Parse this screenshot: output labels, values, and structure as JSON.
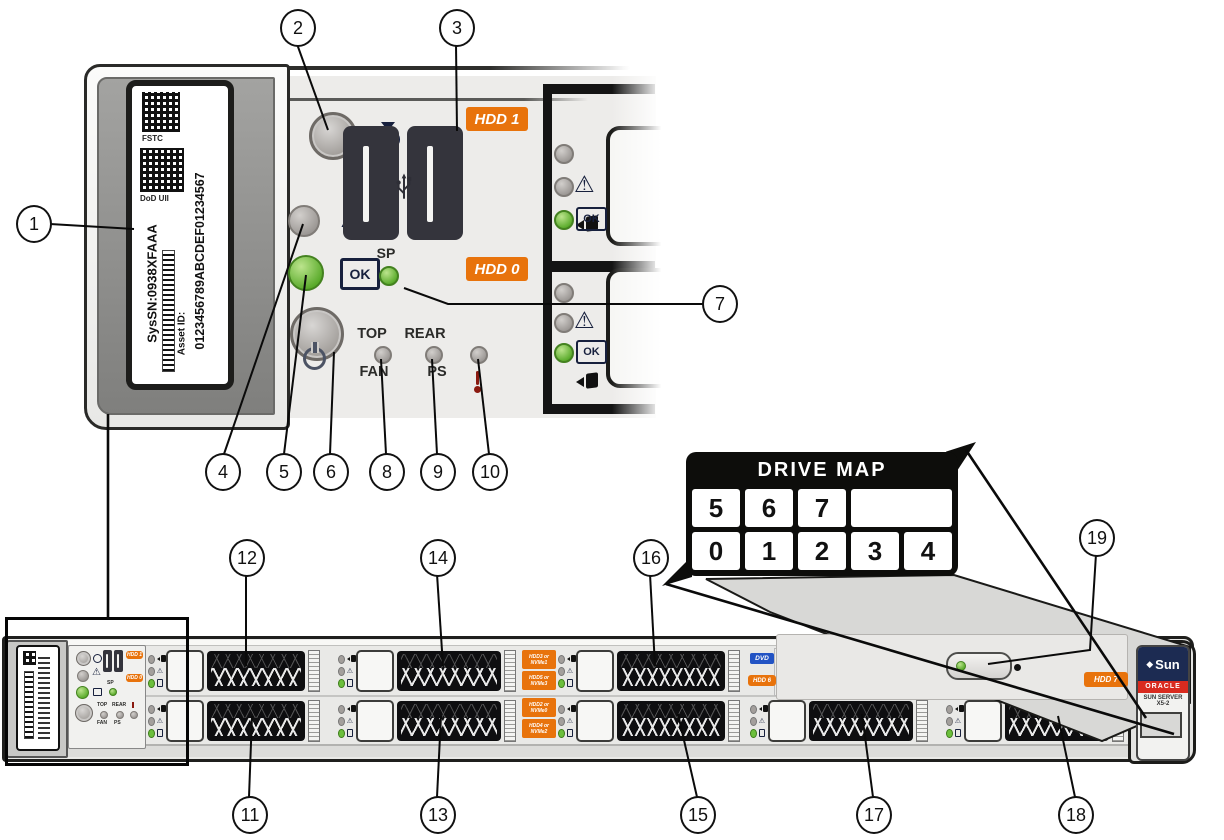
{
  "callouts": [
    "1",
    "2",
    "3",
    "4",
    "5",
    "6",
    "7",
    "8",
    "9",
    "10",
    "11",
    "12",
    "13",
    "14",
    "15",
    "16",
    "17",
    "18",
    "19"
  ],
  "service_label": {
    "qr1_caption": "FSTC",
    "qr2_caption": "DoD UII",
    "system_serial": "SysSN:0938XFAAA",
    "asset_id_label": "Asset ID:",
    "asset_id_value": "0123456789ABCDEF01234567"
  },
  "control_panel": {
    "sp": "SP",
    "ok": "OK",
    "top": "TOP",
    "fan": "FAN",
    "rear": "REAR",
    "ps": "PS",
    "hdd1_tag": "HDD 1",
    "hdd0_tag": "HDD 0"
  },
  "drive_leds": {
    "ok": "OK"
  },
  "drive_map": {
    "title": "DRIVE MAP",
    "row_top": [
      "5",
      "6",
      "7",
      ""
    ],
    "row_bottom": [
      "0",
      "1",
      "2",
      "3",
      "4"
    ]
  },
  "chassis_tags": {
    "dvd": "DVD",
    "hdd6": "HDD 6",
    "hdd7": "HDD 7",
    "bay_labels": [
      "HDD3 or NVMe1",
      "HDD5 or NVMe3",
      "HDD2 or NVMe0",
      "HDD4 or NVMe2"
    ]
  },
  "badge": {
    "brand": "Sun",
    "vendor": "ORACLE",
    "model_line1": "SUN SERVER",
    "model_line2": "X5-2"
  },
  "colors": {
    "accent_orange": "#E8730C",
    "led_green": "#6CBF3C",
    "tag_blue": "#2253C4",
    "oracle_red": "#D92B1F",
    "badge_navy": "#1C2B52",
    "line": "#0A0A0A"
  }
}
